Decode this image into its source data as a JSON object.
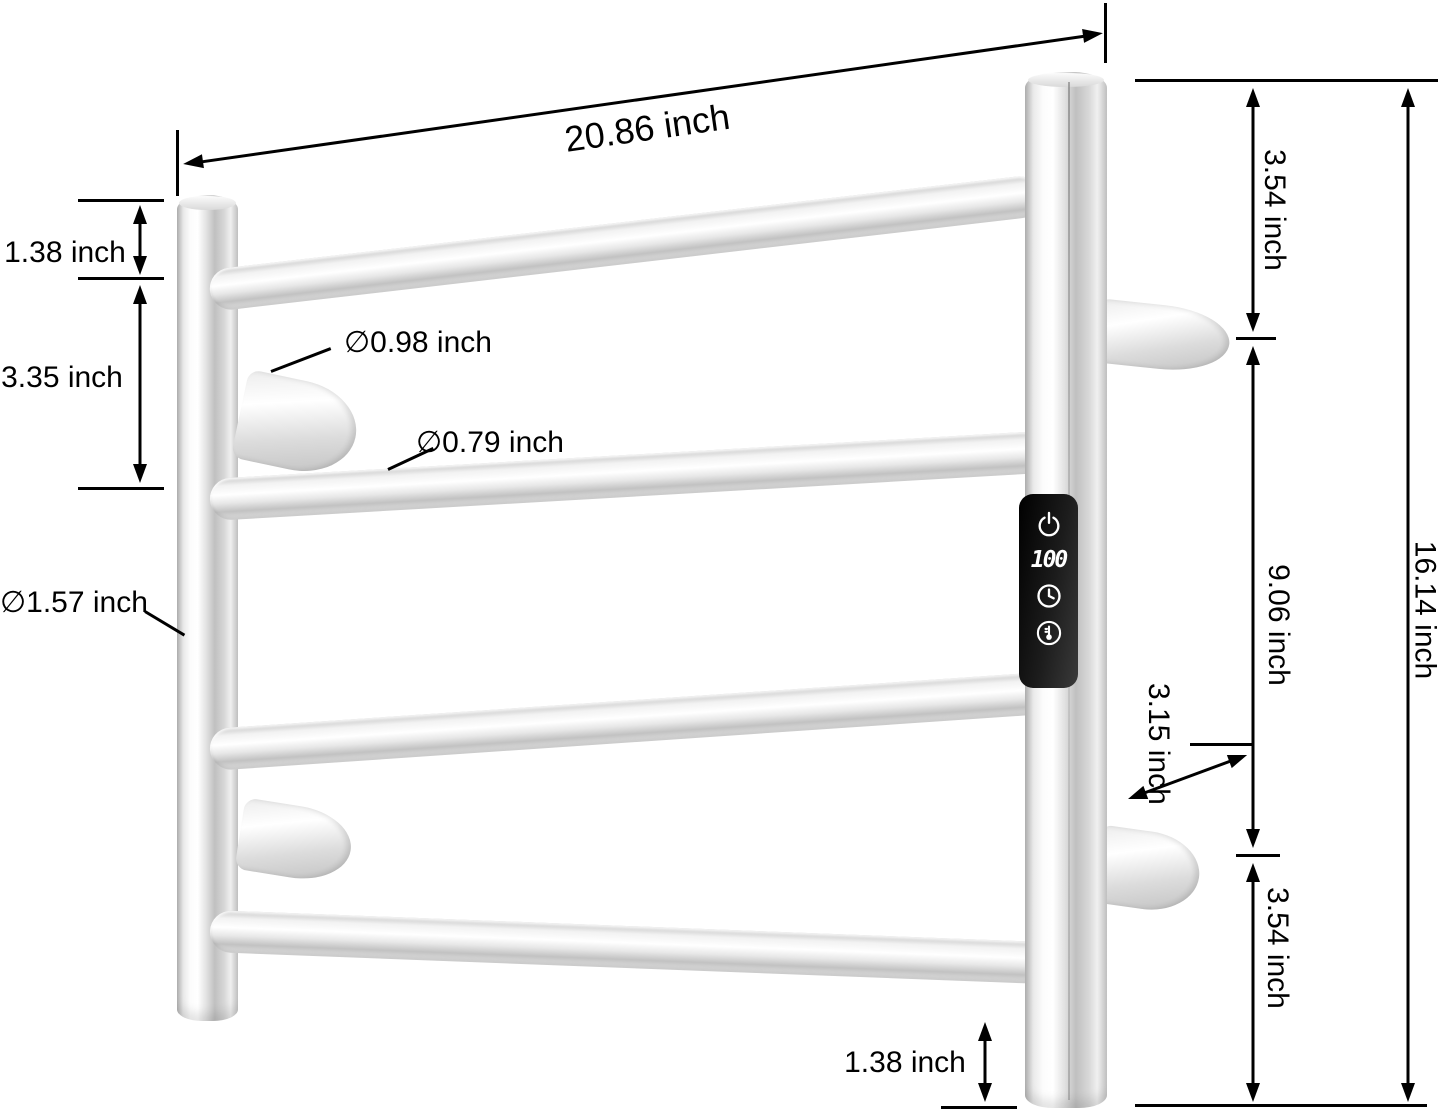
{
  "diagram": {
    "annotation_color": "#000000",
    "labels": {
      "width_top": "20.86 inch",
      "top_offset_left": "1.38 inch",
      "rail_spacing_left": "3.35 inch",
      "post_diameter": "∅1.57 inch",
      "hook_diameter": "∅0.98 inch",
      "bar_diameter": "∅0.79 inch",
      "right_top_offset": "3.54 inch",
      "bracket_spacing": "9.06 inch",
      "bracket_length": "3.15 inch",
      "right_bottom_offset": "3.54 inch",
      "total_height": "16.14 inch",
      "bottom_offset": "1.38 inch"
    },
    "control_panel": {
      "background": "#0d0d0d",
      "foreground": "#ffffff",
      "display_value": "100",
      "buttons": [
        "power-icon",
        "timer-icon",
        "temperature-icon"
      ]
    }
  }
}
